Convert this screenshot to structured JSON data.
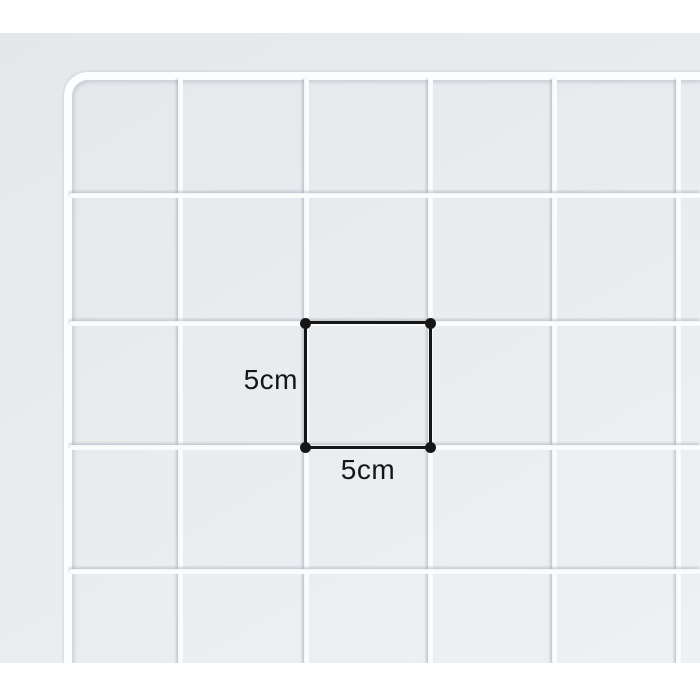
{
  "photo": {
    "background_top_color": "#e5e8eb",
    "background_bottom_color": "#eef1f3",
    "wire_color": "#fcfdfe",
    "wire_shadow_color": "rgba(156,165,178,0.5)",
    "margin_color": "#ffffff"
  },
  "annotation": {
    "line_color": "#161616",
    "height_label": "5cm",
    "width_label": "5cm"
  }
}
